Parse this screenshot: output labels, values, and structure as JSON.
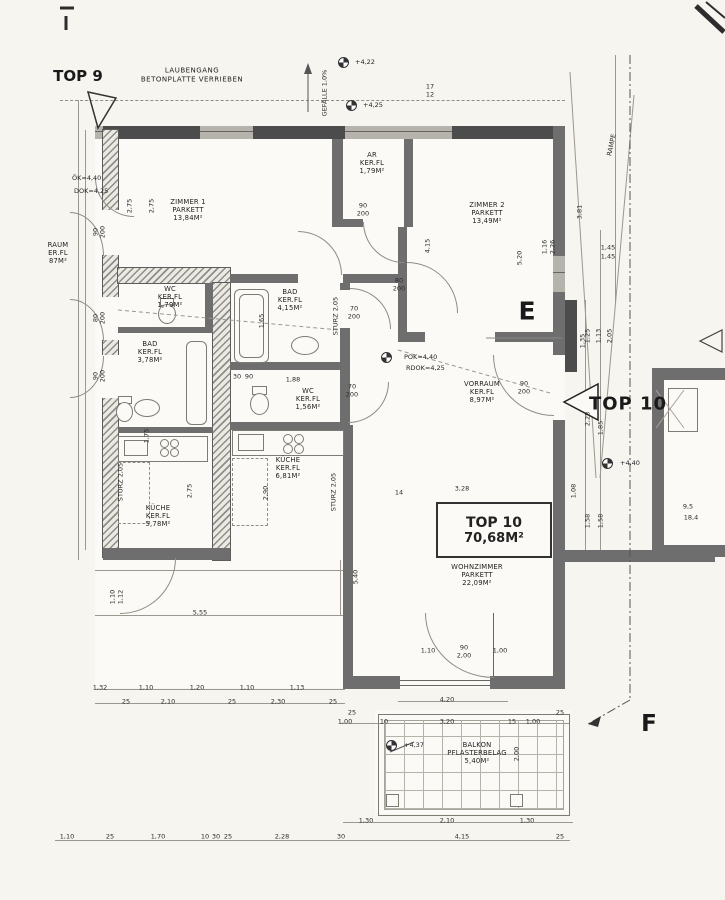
{
  "header": {
    "top9": "TOP 9",
    "laubengang_line1": "LAUBENGANG",
    "laubengang_line2": "BETONPLATTE VERRIEBEN",
    "gefaelle": "GEFÄLLE 1,0%",
    "rampe": "RAMPE",
    "letter_e": "E",
    "letter_f": "F",
    "top10_arrow_label": "TOP 10"
  },
  "top10_box": {
    "line1": "TOP 10",
    "line2": "70,68M²"
  },
  "colors": {
    "paper": "#f6f5f0",
    "wall": "#6e6e6e",
    "wall_dark": "#4c4c4c",
    "line": "#9a988f",
    "ink": "#222222"
  },
  "rooms": [
    {
      "id": "zimmer1",
      "lines": [
        "ZIMMER 1",
        "PARKETT",
        "13,84M²"
      ],
      "x": 188,
      "y": 210
    },
    {
      "id": "ar",
      "lines": [
        "AR",
        "KER.FL",
        "1,79M²"
      ],
      "x": 372,
      "y": 163
    },
    {
      "id": "zimmer2",
      "lines": [
        "ZIMMER 2",
        "PARKETT",
        "13,49M²"
      ],
      "x": 487,
      "y": 213
    },
    {
      "id": "bad-top10",
      "lines": [
        "BAD",
        "KER.FL",
        "4,15M²"
      ],
      "x": 290,
      "y": 300
    },
    {
      "id": "wc-top10",
      "lines": [
        "WC",
        "KER.FL",
        "1,56M²"
      ],
      "x": 308,
      "y": 399
    },
    {
      "id": "kueche-top10",
      "lines": [
        "KÜCHE",
        "KER.FL",
        "6,81M²"
      ],
      "x": 288,
      "y": 468
    },
    {
      "id": "vorraum",
      "lines": [
        "VORRAUM",
        "KER.FL",
        "8,97M²"
      ],
      "x": 482,
      "y": 392
    },
    {
      "id": "wohnzimmer",
      "lines": [
        "WOHNZIMMER",
        "PARKETT",
        "22,09M²"
      ],
      "x": 477,
      "y": 575
    },
    {
      "id": "balkon",
      "lines": [
        "BALKON",
        "PFLASTERBELAG",
        "5,40M²"
      ],
      "x": 477,
      "y": 753
    },
    {
      "id": "wc-top9",
      "lines": [
        "WC",
        "KER.FL",
        "1,79M²"
      ],
      "x": 170,
      "y": 297
    },
    {
      "id": "bad-top9",
      "lines": [
        "BAD",
        "KER.FL",
        "3,78M²"
      ],
      "x": 150,
      "y": 352
    },
    {
      "id": "kueche-top9",
      "lines": [
        "KÜCHE",
        "KER.FL",
        "5,78M²"
      ],
      "x": 158,
      "y": 516
    },
    {
      "id": "raum-top9-cut",
      "lines": [
        "RAUM",
        "ER.FL",
        "87M²"
      ],
      "x": 58,
      "y": 253
    }
  ],
  "levels": [
    {
      "t": "+4,22",
      "sx": 338,
      "sy": 57,
      "tx": 355,
      "ty": 62
    },
    {
      "t": "+4,25",
      "sx": 346,
      "sy": 100,
      "tx": 363,
      "ty": 105
    },
    {
      "t": "POK=4,40",
      "sx": 381,
      "sy": 352,
      "tx": 404,
      "ty": 357
    },
    {
      "t": "RDOK=4,25",
      "tx": 406,
      "ty": 368
    },
    {
      "t": "+4,40",
      "sx": 602,
      "sy": 458,
      "tx": 620,
      "ty": 463
    },
    {
      "t": "+4,37",
      "sx": 386,
      "sy": 740,
      "tx": 404,
      "ty": 745
    },
    {
      "t": "ÖK=4,40",
      "tx": 72,
      "ty": 178
    },
    {
      "t": "DOK=4,25",
      "tx": 74,
      "ty": 191
    }
  ],
  "dims": [
    {
      "t": "17",
      "x": 430,
      "y": 87
    },
    {
      "t": "12",
      "x": 430,
      "y": 95
    },
    {
      "t": "3,81",
      "x": 580,
      "y": 212,
      "r": 1
    },
    {
      "t": "1,45",
      "x": 608,
      "y": 248
    },
    {
      "t": "1,45",
      "x": 608,
      "y": 257
    },
    {
      "t": "1,25",
      "x": 588,
      "y": 336,
      "r": 1
    },
    {
      "t": "1,13",
      "x": 599,
      "y": 336,
      "r": 1
    },
    {
      "t": "2,05",
      "x": 610,
      "y": 336,
      "r": 1
    },
    {
      "t": "2,75",
      "x": 130,
      "y": 206,
      "r": 1
    },
    {
      "t": "2,75",
      "x": 152,
      "y": 206,
      "r": 1
    },
    {
      "t": "90",
      "x": 96,
      "y": 232,
      "r": 1
    },
    {
      "t": "200",
      "x": 103,
      "y": 232,
      "r": 1
    },
    {
      "t": "80",
      "x": 96,
      "y": 318,
      "r": 1
    },
    {
      "t": "200",
      "x": 103,
      "y": 318,
      "r": 1
    },
    {
      "t": "90",
      "x": 96,
      "y": 376,
      "r": 1
    },
    {
      "t": "200",
      "x": 103,
      "y": 376,
      "r": 1
    },
    {
      "t": "90",
      "x": 363,
      "y": 206
    },
    {
      "t": "200",
      "x": 363,
      "y": 214
    },
    {
      "t": "80",
      "x": 399,
      "y": 281
    },
    {
      "t": "200",
      "x": 399,
      "y": 289
    },
    {
      "t": "4,15",
      "x": 428,
      "y": 246,
      "r": 1
    },
    {
      "t": "5,20",
      "x": 520,
      "y": 258,
      "r": 1
    },
    {
      "t": "1,16",
      "x": 545,
      "y": 247,
      "r": 1
    },
    {
      "t": "2,26",
      "x": 553,
      "y": 247,
      "r": 1
    },
    {
      "t": "1,65",
      "x": 262,
      "y": 321,
      "r": 1
    },
    {
      "t": "70",
      "x": 354,
      "y": 309
    },
    {
      "t": "200",
      "x": 354,
      "y": 317
    },
    {
      "t": "70",
      "x": 352,
      "y": 387
    },
    {
      "t": "200",
      "x": 352,
      "y": 395
    },
    {
      "t": "30",
      "x": 237,
      "y": 377
    },
    {
      "t": "90",
      "x": 249,
      "y": 377
    },
    {
      "t": "1,88",
      "x": 293,
      "y": 380
    },
    {
      "t": "2,75",
      "x": 190,
      "y": 491,
      "r": 1
    },
    {
      "t": "2,90",
      "x": 266,
      "y": 493,
      "r": 1
    },
    {
      "t": "1,75",
      "x": 147,
      "y": 436,
      "r": 1
    },
    {
      "t": "STURZ 2,05",
      "x": 121,
      "y": 482,
      "r": 1
    },
    {
      "t": "STURZ 2,05",
      "x": 334,
      "y": 492,
      "r": 1
    },
    {
      "t": "STURZ 2,05",
      "x": 336,
      "y": 316,
      "r": 1
    },
    {
      "t": "90",
      "x": 524,
      "y": 384
    },
    {
      "t": "200",
      "x": 524,
      "y": 392
    },
    {
      "t": "1,35",
      "x": 583,
      "y": 341,
      "r": 1
    },
    {
      "t": "3,28",
      "x": 462,
      "y": 489
    },
    {
      "t": "14",
      "x": 399,
      "y": 493
    },
    {
      "t": "5,40",
      "x": 356,
      "y": 577,
      "r": 1
    },
    {
      "t": "2,28",
      "x": 588,
      "y": 419,
      "r": 1
    },
    {
      "t": "1,85",
      "x": 601,
      "y": 428,
      "r": 1
    },
    {
      "t": "1,08",
      "x": 574,
      "y": 491,
      "r": 1
    },
    {
      "t": "1,58",
      "x": 588,
      "y": 521,
      "r": 1
    },
    {
      "t": "1,58",
      "x": 601,
      "y": 521,
      "r": 1
    },
    {
      "t": "9,5",
      "x": 688,
      "y": 507
    },
    {
      "t": "18,4",
      "x": 691,
      "y": 518
    },
    {
      "t": "1,10",
      "x": 428,
      "y": 651
    },
    {
      "t": "90",
      "x": 464,
      "y": 648
    },
    {
      "t": "2,00",
      "x": 464,
      "y": 656
    },
    {
      "t": "1,00",
      "x": 500,
      "y": 651
    },
    {
      "t": "4,20",
      "x": 447,
      "y": 700
    },
    {
      "t": "25",
      "x": 352,
      "y": 713
    },
    {
      "t": "25",
      "x": 560,
      "y": 713
    },
    {
      "t": "1,00",
      "x": 345,
      "y": 722
    },
    {
      "t": "10",
      "x": 384,
      "y": 722
    },
    {
      "t": "3,20",
      "x": 447,
      "y": 722
    },
    {
      "t": "15",
      "x": 512,
      "y": 722
    },
    {
      "t": "1,00",
      "x": 533,
      "y": 722
    },
    {
      "t": "2,00",
      "x": 517,
      "y": 754,
      "r": 1
    },
    {
      "t": "1,30",
      "x": 366,
      "y": 821
    },
    {
      "t": "2,10",
      "x": 447,
      "y": 821
    },
    {
      "t": "1,30",
      "x": 527,
      "y": 821
    },
    {
      "t": "1,32",
      "x": 100,
      "y": 688
    },
    {
      "t": "1,10",
      "x": 146,
      "y": 688
    },
    {
      "t": "1,20",
      "x": 197,
      "y": 688
    },
    {
      "t": "1,10",
      "x": 247,
      "y": 688
    },
    {
      "t": "1,13",
      "x": 297,
      "y": 688
    },
    {
      "t": "25",
      "x": 126,
      "y": 702
    },
    {
      "t": "2,10",
      "x": 168,
      "y": 702
    },
    {
      "t": "25",
      "x": 232,
      "y": 702
    },
    {
      "t": "2,30",
      "x": 278,
      "y": 702
    },
    {
      "t": "25",
      "x": 333,
      "y": 702
    },
    {
      "t": "5,55",
      "x": 200,
      "y": 613
    },
    {
      "t": "1,10",
      "x": 113,
      "y": 597,
      "r": 1
    },
    {
      "t": "1,12",
      "x": 121,
      "y": 597,
      "r": 1
    },
    {
      "t": "1,10",
      "x": 67,
      "y": 837
    },
    {
      "t": "25",
      "x": 110,
      "y": 837
    },
    {
      "t": "1,70",
      "x": 158,
      "y": 837
    },
    {
      "t": "10",
      "x": 205,
      "y": 837
    },
    {
      "t": "30",
      "x": 216,
      "y": 837
    },
    {
      "t": "25",
      "x": 228,
      "y": 837
    },
    {
      "t": "2,28",
      "x": 282,
      "y": 837
    },
    {
      "t": "30",
      "x": 341,
      "y": 837
    },
    {
      "t": "4,15",
      "x": 462,
      "y": 837
    },
    {
      "t": "25",
      "x": 560,
      "y": 837
    }
  ]
}
